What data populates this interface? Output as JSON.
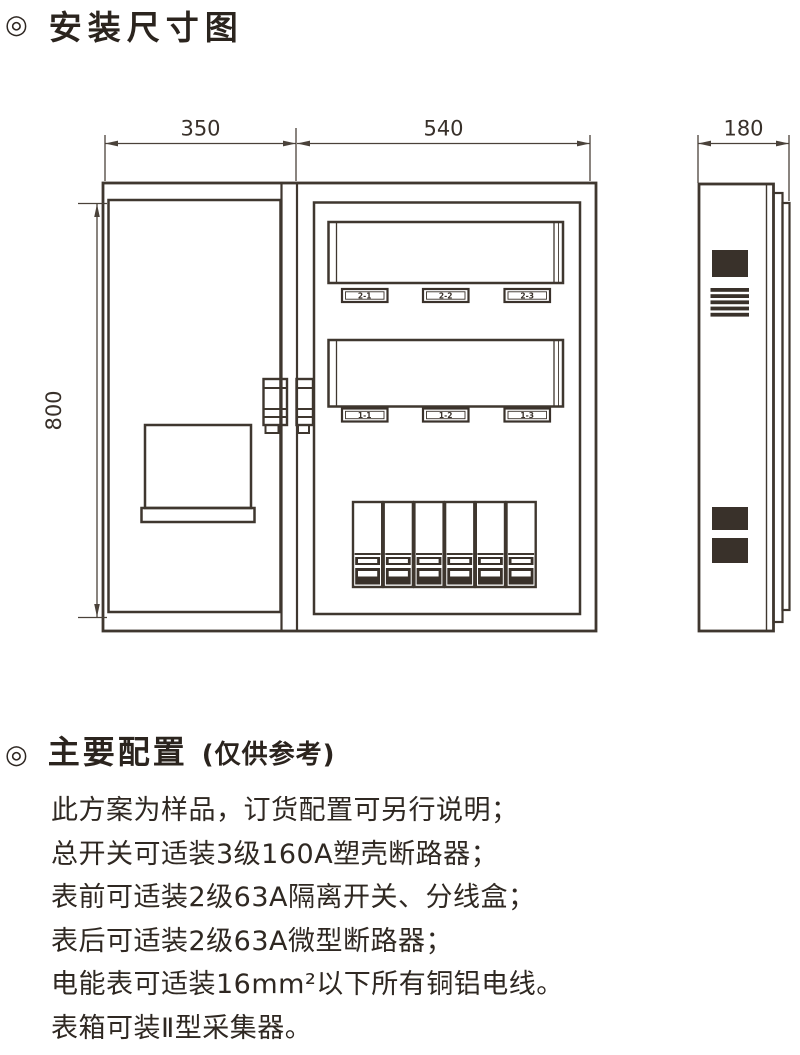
{
  "page": {
    "background": "#ffffff",
    "ink_color": "#3f372f"
  },
  "section_install": {
    "bullet_icon": "◎",
    "title": "安装尺寸图"
  },
  "drawing": {
    "front_view": {
      "width_left_label": "350",
      "width_right_label": "540",
      "height_label": "800",
      "meter_window_labels_row1": [
        "2-1",
        "2-2",
        "2-3"
      ],
      "meter_window_labels_row2": [
        "1-1",
        "1-2",
        "1-3"
      ]
    },
    "side_view": {
      "depth_label": "180"
    }
  },
  "section_config": {
    "bullet_icon": "◎",
    "title": "主要配置",
    "subtitle": "(仅供参考)",
    "lines": [
      "此方案为样品，订货配置可另行说明；",
      "总开关可适装3级160A塑壳断路器；",
      "表前可适装2级63A隔离开关、分线盒；",
      "表后可适装2级63A微型断路器；",
      "电能表可适装16mm²以下所有铜铝电线。",
      "表箱可装Ⅱ型采集器。"
    ]
  }
}
